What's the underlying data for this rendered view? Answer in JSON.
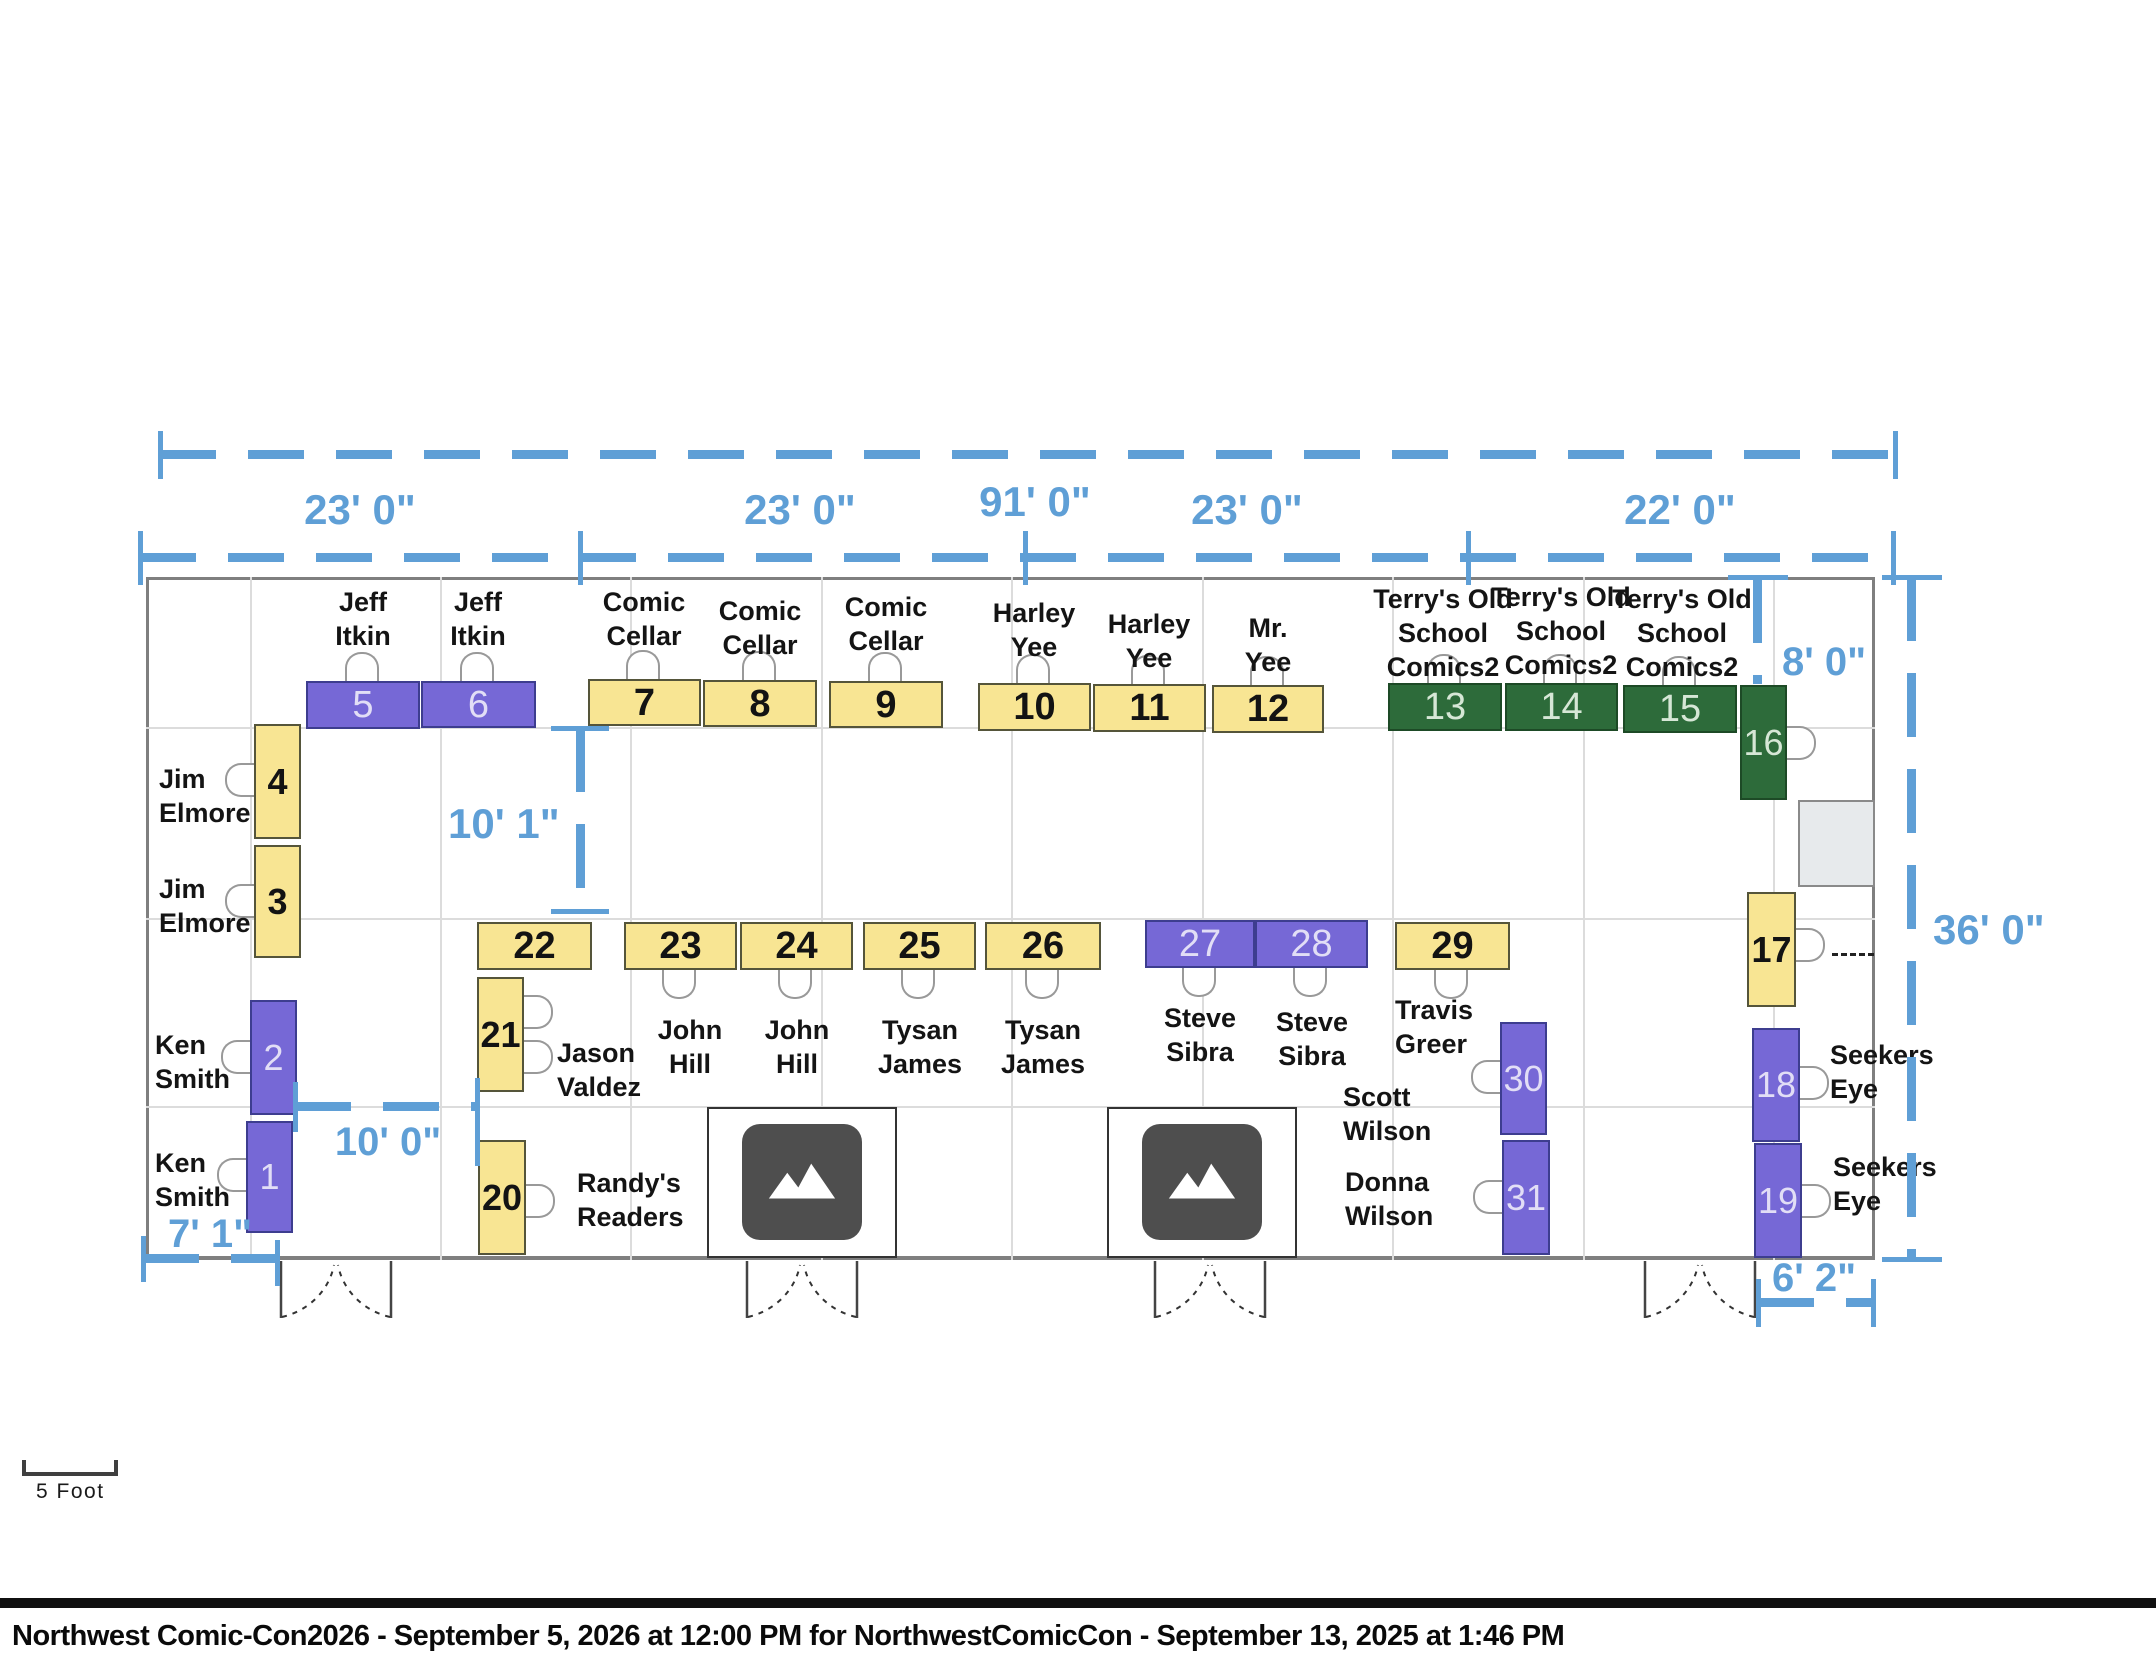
{
  "title_bar": {
    "text": "Northwest Comic-Con2026 - September 5, 2026 at 12:00 PM for NorthwestComicCon - September 13, 2025 at 1:46 PM"
  },
  "scale_indicator": {
    "label": "5 Foot"
  },
  "dimensions": {
    "total_width": "91' 0\"",
    "top_segments": [
      "23' 0\"",
      "23' 0\"",
      "23' 0\"",
      "22' 0\""
    ],
    "inner_top_right": "8' 0\"",
    "right_height": "36' 0\"",
    "bottom_right": "6' 2\"",
    "inner_left": "10' 1\"",
    "bottom_gap": "10' 0\"",
    "bottom_left": "7' 1\""
  },
  "colors": {
    "booth_yellow": "#f8e593",
    "booth_purple": "#7668d6",
    "booth_green": "#2d6b3a",
    "dimension_blue": "#5f9fd6"
  },
  "booths": [
    {
      "number": "1",
      "vendor": "Ken Smith",
      "type": "purple"
    },
    {
      "number": "2",
      "vendor": "Ken Smith",
      "type": "purple"
    },
    {
      "number": "3",
      "vendor": "Jim Elmore",
      "type": "yellow"
    },
    {
      "number": "4",
      "vendor": "Jim Elmore",
      "type": "yellow"
    },
    {
      "number": "5",
      "vendor": "Jeff Itkin",
      "type": "purple"
    },
    {
      "number": "6",
      "vendor": "Jeff Itkin",
      "type": "purple"
    },
    {
      "number": "7",
      "vendor": "Comic Cellar",
      "type": "yellow"
    },
    {
      "number": "8",
      "vendor": "Comic Cellar",
      "type": "yellow"
    },
    {
      "number": "9",
      "vendor": "Comic Cellar",
      "type": "yellow"
    },
    {
      "number": "10",
      "vendor": "Harley Yee",
      "type": "yellow"
    },
    {
      "number": "11",
      "vendor": "Harley Yee",
      "type": "yellow"
    },
    {
      "number": "12",
      "vendor": "Mr. Yee",
      "type": "yellow"
    },
    {
      "number": "13",
      "vendor": "Terry's Old School Comics2",
      "type": "green"
    },
    {
      "number": "14",
      "vendor": "Terry's Old School Comics2",
      "type": "green"
    },
    {
      "number": "15",
      "vendor": "Terry's Old School Comics2",
      "type": "green"
    },
    {
      "number": "16",
      "vendor": "",
      "type": "green"
    },
    {
      "number": "17",
      "vendor": "",
      "type": "yellow"
    },
    {
      "number": "18",
      "vendor": "Seekers Eye",
      "type": "purple"
    },
    {
      "number": "19",
      "vendor": "Seekers Eye",
      "type": "purple"
    },
    {
      "number": "20",
      "vendor": "Randy's Readers",
      "type": "yellow"
    },
    {
      "number": "21",
      "vendor": "Jason Valdez",
      "type": "yellow"
    },
    {
      "number": "22",
      "vendor": "",
      "type": "yellow"
    },
    {
      "number": "23",
      "vendor": "John Hill",
      "type": "yellow"
    },
    {
      "number": "24",
      "vendor": "John Hill",
      "type": "yellow"
    },
    {
      "number": "25",
      "vendor": "Tysan James",
      "type": "yellow"
    },
    {
      "number": "26",
      "vendor": "Tysan James",
      "type": "yellow"
    },
    {
      "number": "27",
      "vendor": "Steve Sibra",
      "type": "purple"
    },
    {
      "number": "28",
      "vendor": "Steve Sibra",
      "type": "purple"
    },
    {
      "number": "29",
      "vendor": "Travis Greer",
      "type": "yellow"
    },
    {
      "number": "30",
      "vendor": "Scott Wilson",
      "type": "purple"
    },
    {
      "number": "31",
      "vendor": "Donna Wilson",
      "type": "purple"
    }
  ]
}
